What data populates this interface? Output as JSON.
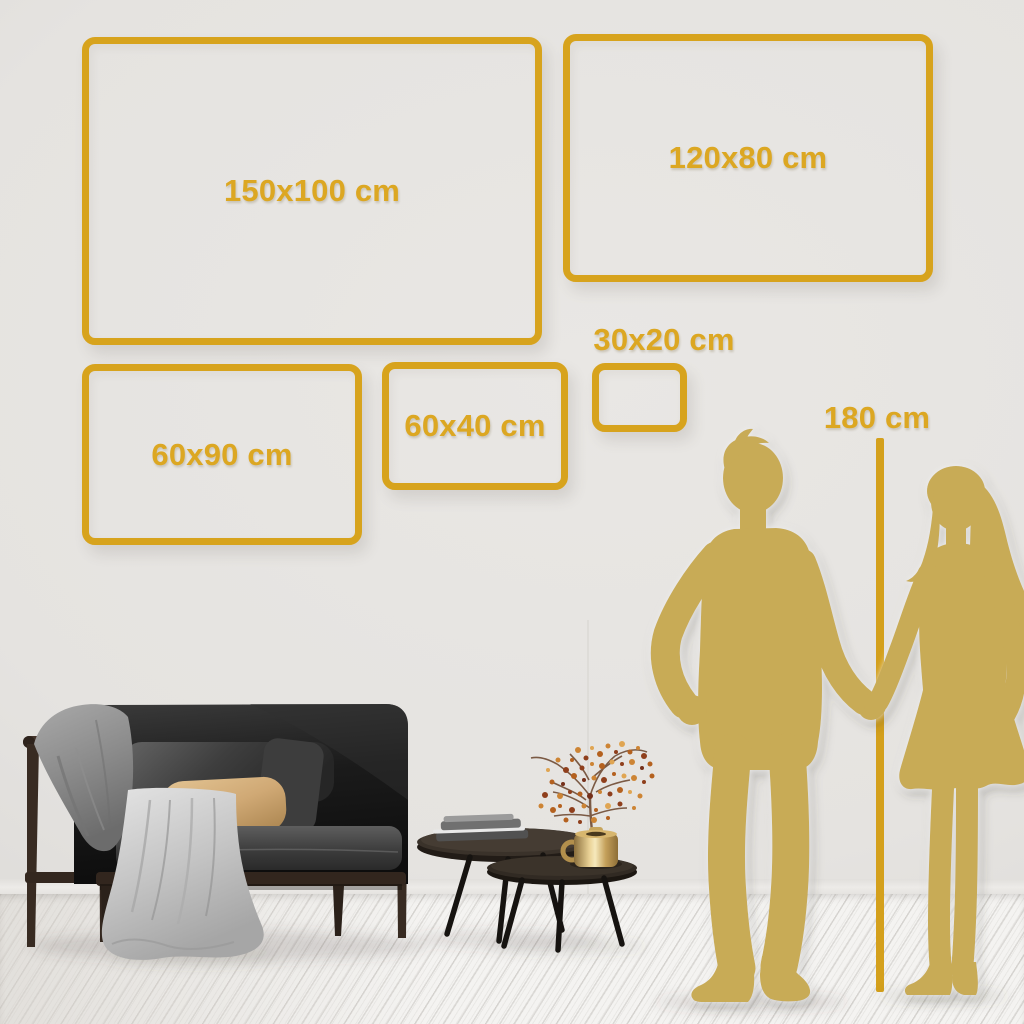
{
  "frames": [
    {
      "id": "150x100",
      "label": "150x100 cm"
    },
    {
      "id": "120x80",
      "label": "120x80 cm"
    },
    {
      "id": "60x90",
      "label": "60x90 cm"
    },
    {
      "id": "60x40",
      "label": "60x40 cm"
    },
    {
      "id": "30x20",
      "label": "30x20 cm"
    }
  ],
  "height_marker": {
    "label": "180 cm"
  },
  "palette": {
    "accent_gold": "#d7a31d",
    "label_gold": "#dca722",
    "silhouette_gold": "#c8ab56",
    "wall_gray": "#e4e2df",
    "floor_white": "#f4f3f1",
    "sofa_black": "#1a1a1a",
    "wood_brown": "#3a2d24",
    "pillow_beige": "#d2ab76",
    "blanket_gray": "#8c8c8c",
    "cloth_light": "#cfcfcf",
    "vase_gold": "#c9a85f",
    "berry_orange": "#b4611f"
  }
}
